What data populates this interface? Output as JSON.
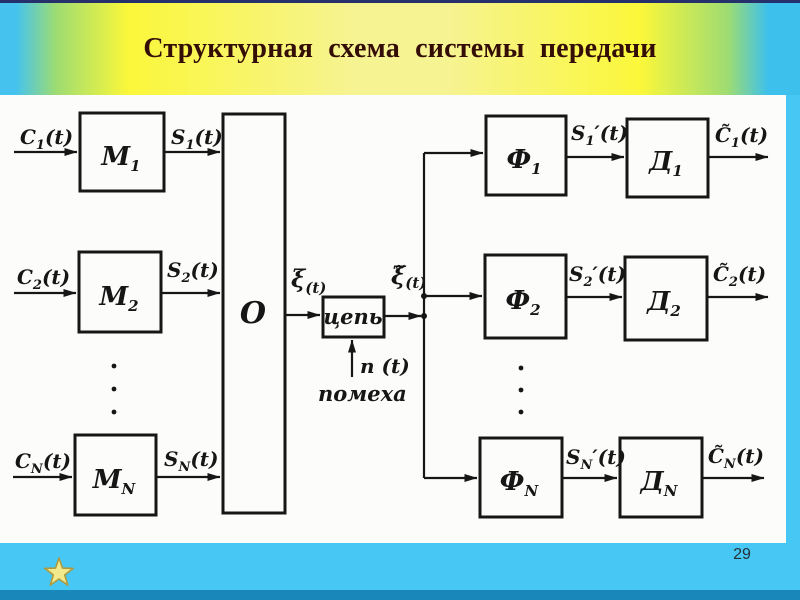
{
  "slide": {
    "title": "Структурная схема системы передачи",
    "page_number": "29"
  },
  "colors": {
    "frame_blue": "#47c8f4",
    "bottom_strip_blue": "#1a87ba",
    "band_yellow": "#fbf73a",
    "band_center_yellow": "#f6f392",
    "band_edge_blue": "#45c3ee",
    "title_text": "#330d06",
    "ink": "#161616",
    "star_fill": "#f2e88c",
    "star_edge": "#ad9a3e"
  },
  "diagram": {
    "blocks": {
      "m1": {
        "letter": "М",
        "sub": "1"
      },
      "m2": {
        "letter": "М",
        "sub": "2"
      },
      "mn": {
        "letter": "М",
        "sub": "N"
      },
      "combiner": {
        "letter": "О"
      },
      "channel": {
        "letter": "цепь"
      },
      "f1": {
        "letter": "Ф",
        "sub": "1"
      },
      "f2": {
        "letter": "Ф",
        "sub": "2"
      },
      "fn": {
        "letter": "Ф",
        "sub": "N"
      },
      "d1": {
        "letter": "Д",
        "sub": "1"
      },
      "d2": {
        "letter": "Д",
        "sub": "2"
      },
      "dn": {
        "letter": "Д",
        "sub": "N"
      }
    },
    "signals": {
      "in1": {
        "pre": "C",
        "sub": "1",
        "post": "(t)"
      },
      "in2": {
        "pre": "C",
        "sub": "2",
        "post": "(t)"
      },
      "inn": {
        "pre": "C",
        "sub": "N",
        "post": "(t)"
      },
      "s1": {
        "pre": "S",
        "sub": "1",
        "post": "(t)"
      },
      "s2": {
        "pre": "S",
        "sub": "2",
        "post": "(t)"
      },
      "sn": {
        "pre": "S",
        "sub": "N",
        "post": "(t)"
      },
      "sum": {
        "pre": "ξ",
        "post": "(t)"
      },
      "sum_out": {
        "pre": "ξ̃",
        "post": "(t)"
      },
      "noise": "n (t)",
      "noise_caption": "помеха",
      "f1_out": {
        "pre": "S",
        "sub": "1",
        "post": "′(t)"
      },
      "f2_out": {
        "pre": "S",
        "sub": "2",
        "post": "′(t)"
      },
      "fn_out": {
        "pre": "S",
        "sub": "N",
        "post": "′(t)"
      },
      "out1": {
        "pre": "C̃",
        "sub": "1",
        "post": "(t)"
      },
      "out2": {
        "pre": "C̃",
        "sub": "2",
        "post": "(t)"
      },
      "outn": {
        "pre": "C̃",
        "sub": "N",
        "post": "(t)"
      }
    }
  }
}
